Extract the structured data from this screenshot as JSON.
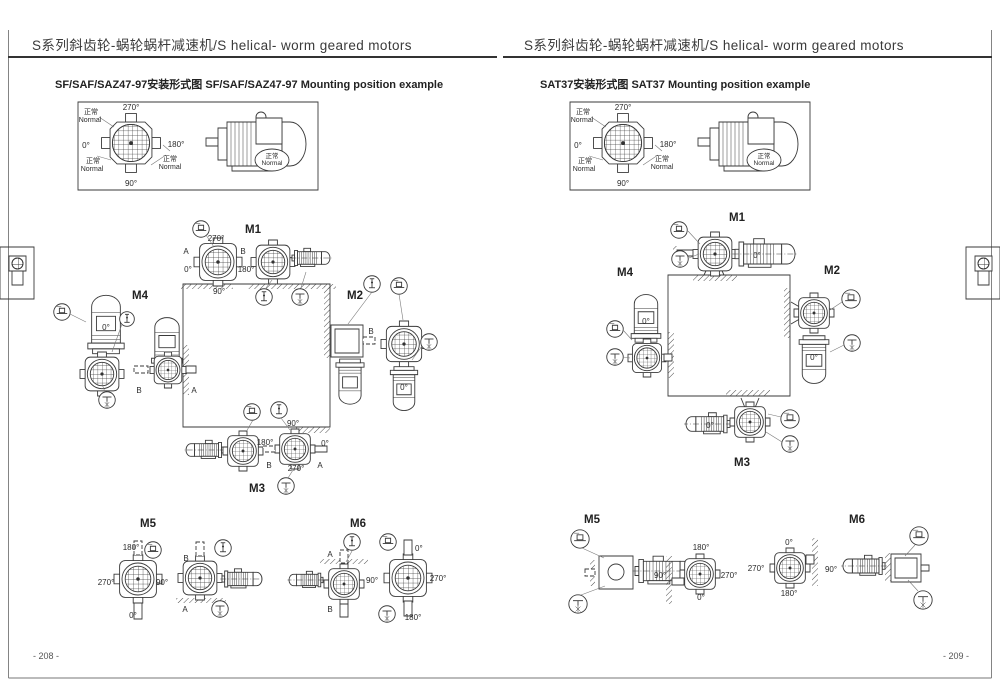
{
  "pages": [
    {
      "header": "S系列斜齿轮-蜗轮蜗杆减速机/S helical- worm geared motors",
      "subtitle": "SF/SAF/SAZ47-97安装形式图  SF/SAF/SAZ47-97 Mounting position example",
      "page_number": "- 208 -",
      "compass": {
        "top": "270°",
        "left": "0°",
        "right": "180°",
        "bottom": "90°",
        "normal_cn": "正常",
        "normal_en": "Normal"
      },
      "m1": {
        "label": "M1",
        "letter_left": "A",
        "letter_right": "B",
        "top": "270°",
        "left": "0°",
        "right": "180°",
        "bottom": "90°"
      },
      "m2": {
        "label": "M2",
        "letter": "B",
        "motor_angle": "0°"
      },
      "m3": {
        "label": "M3",
        "letter_left": "B",
        "letter_right": "A",
        "top": "90°",
        "left": "180°",
        "right": "0°",
        "bottom": "270°"
      },
      "m4": {
        "label": "M4",
        "motor_angle": "0°",
        "letter_left": "B",
        "letter_right": "A"
      },
      "m5": {
        "label": "M5",
        "letter_top": "B",
        "letter_bottom": "A",
        "top": "180°",
        "left": "270°",
        "right": "90°",
        "bottom": "0°"
      },
      "m6": {
        "label": "M6",
        "letter_top": "A",
        "letter_bottom": "B",
        "top": "0°",
        "left": "90°",
        "right": "270°",
        "bottom": "180°"
      }
    },
    {
      "header": "S系列斜齿轮-蜗轮蜗杆减速机/S helical- worm geared motors",
      "subtitle": "SAT37安装形式图  SAT37 Mounting position example",
      "page_number": "- 209 -",
      "compass": {
        "top": "270°",
        "left": "0°",
        "right": "180°",
        "bottom": "90°",
        "normal_cn": "正常",
        "normal_en": "Normal"
      },
      "m1": {
        "label": "M1",
        "motor_angle": "0°"
      },
      "m2": {
        "label": "M2",
        "motor_angle": "0°"
      },
      "m3": {
        "label": "M3",
        "motor_angle": "0°"
      },
      "m4": {
        "label": "M4",
        "motor_angle": "0°"
      },
      "m5": {
        "label": "M5",
        "top": "180°",
        "left": "90°",
        "right": "270°",
        "bottom": "0°"
      },
      "m6": {
        "label": "M6",
        "top": "0°",
        "left": "270°",
        "right": "90°",
        "bottom": "180°"
      }
    }
  ],
  "icons": {
    "oil_level": "oil-level-icon",
    "breather": "breather-valve-icon",
    "drain": "oil-drain-icon",
    "thumbnail": "gearmotor-thumbnail-icon"
  },
  "colors": {
    "ink": "#333333",
    "line": "#3a3a3a",
    "leader": "#777777",
    "tab_bg": "#d9d9d9",
    "paper": "#ffffff"
  }
}
